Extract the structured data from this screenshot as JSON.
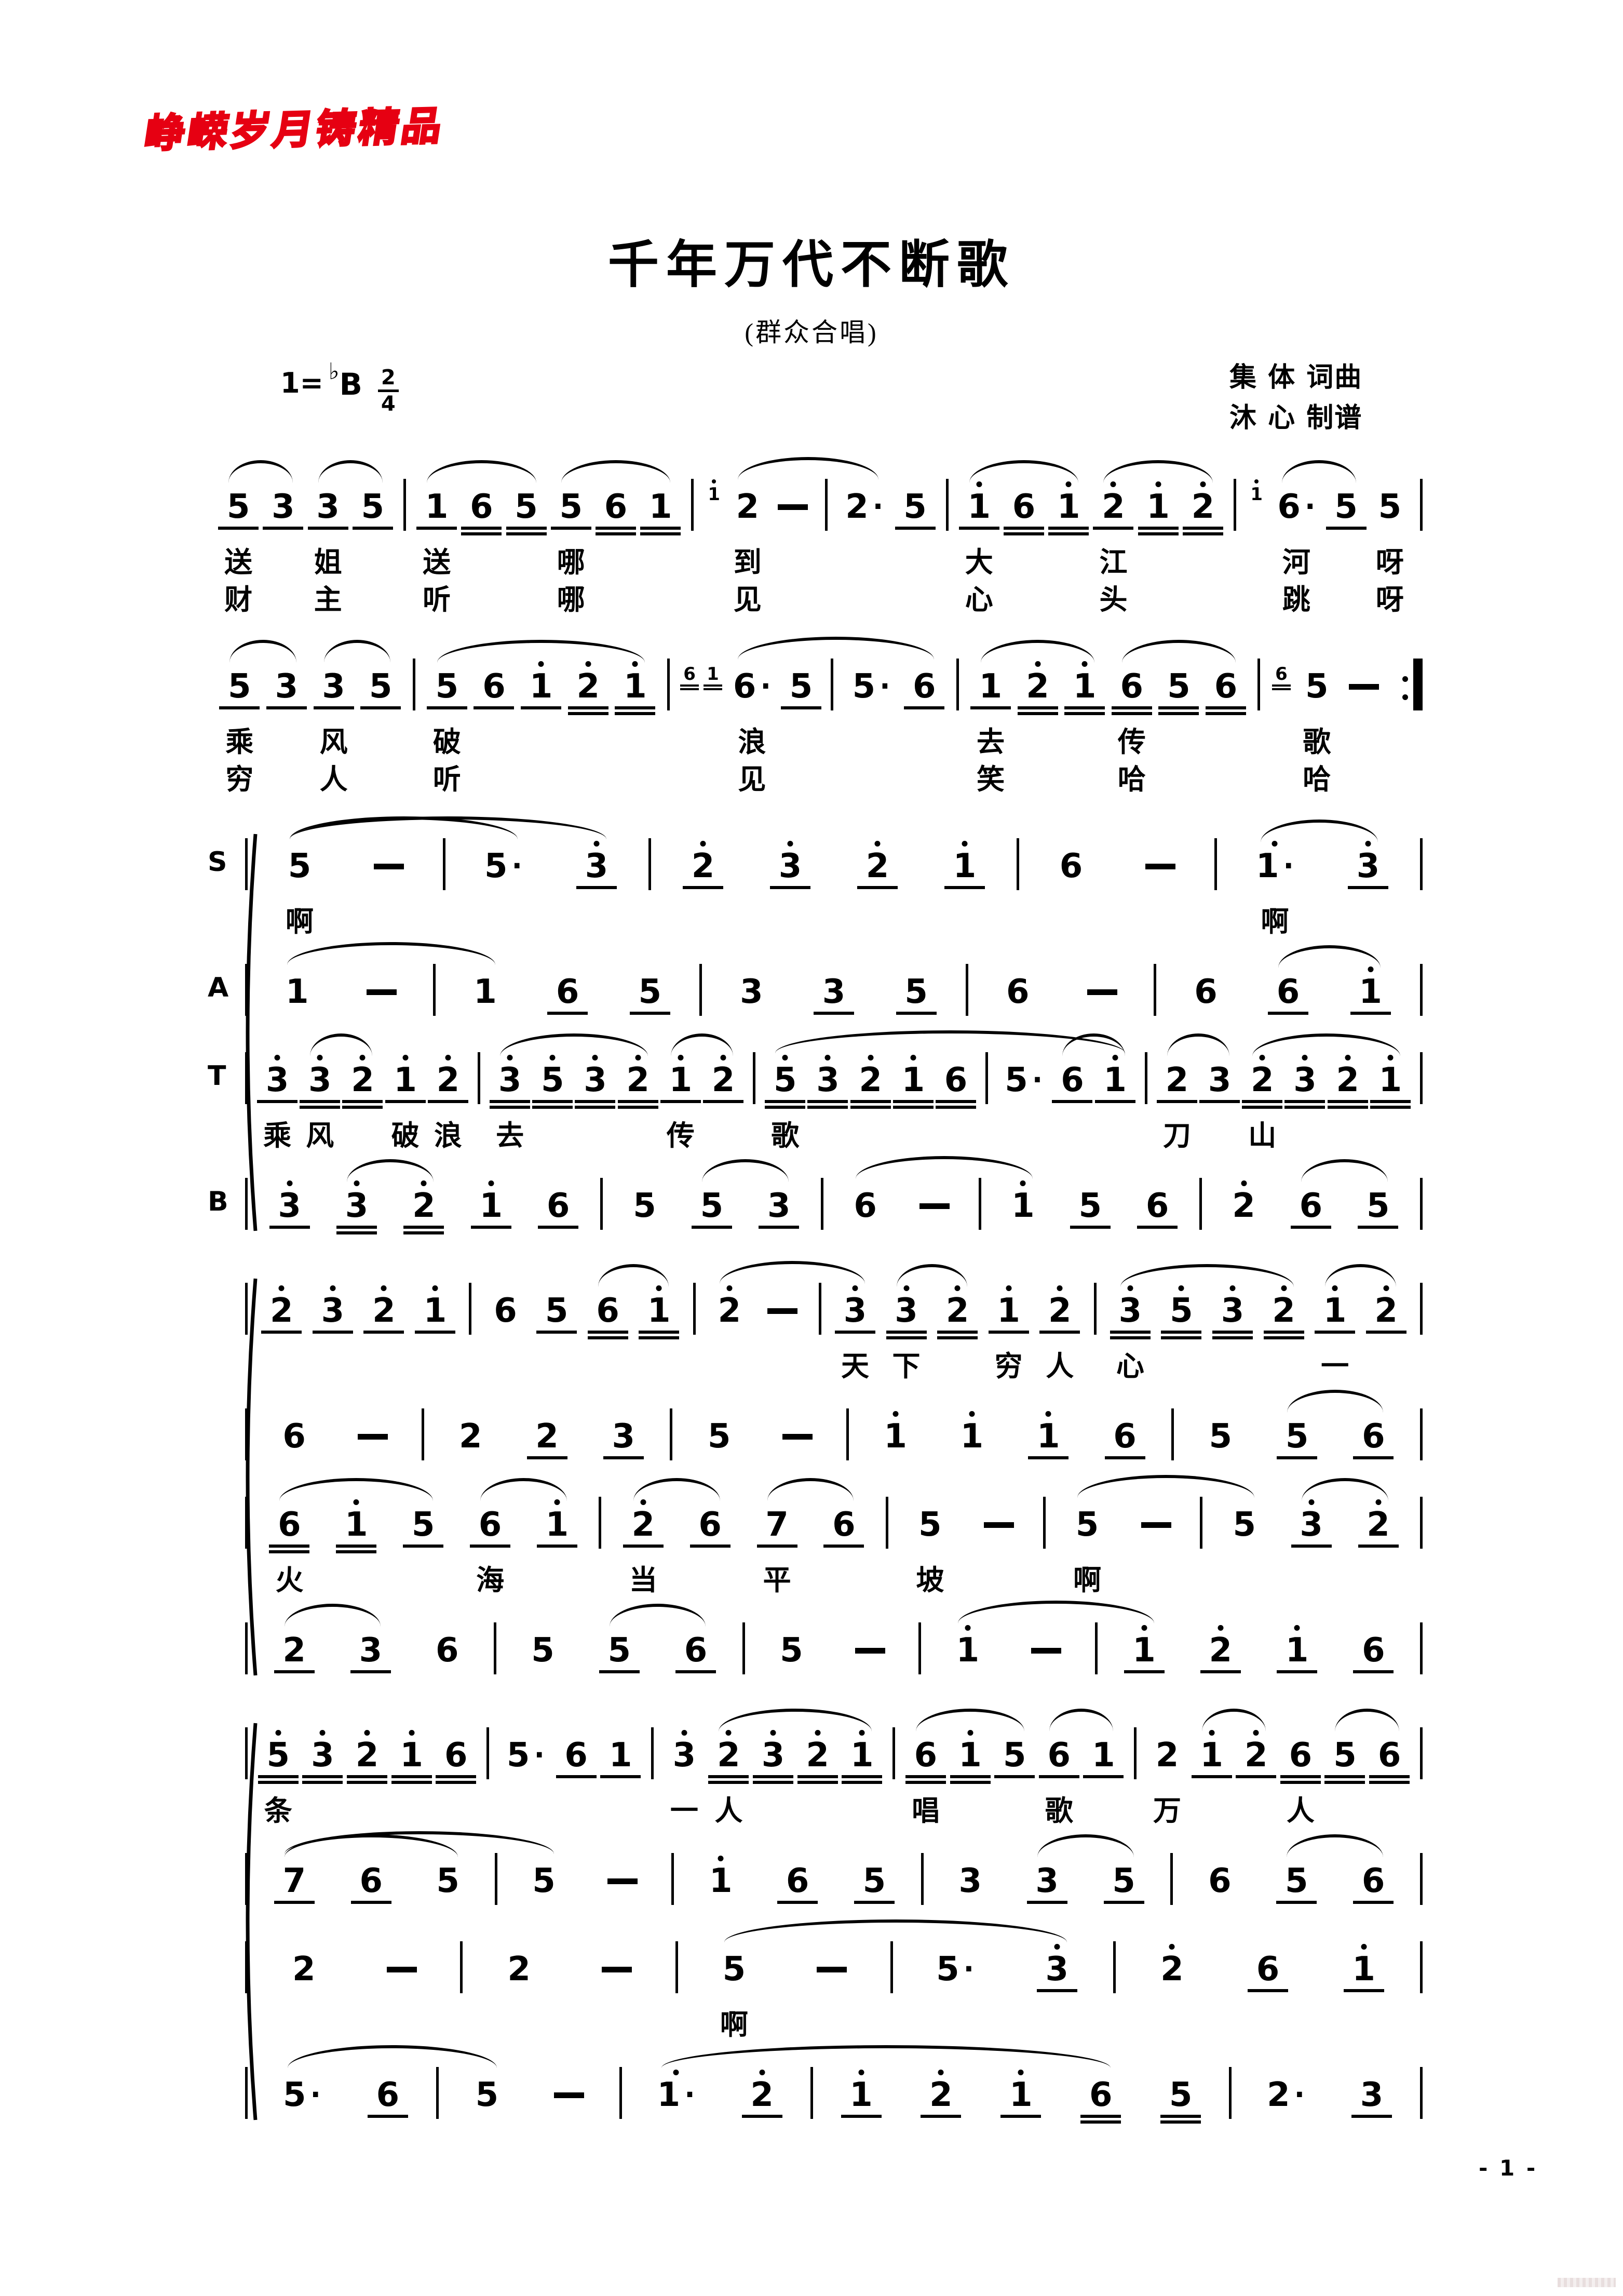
{
  "watermark_text": "峥嵘岁月铸精品",
  "title": "千年万代不断歌",
  "subtitle": "(群众合唱)",
  "key": {
    "prefix": "1=",
    "flat": "♭",
    "letter": "B",
    "meter_top": "2",
    "meter_bottom": "4"
  },
  "credits": {
    "line1": "集 体 词曲",
    "line2": "沐 心 制谱"
  },
  "page_number": "- 1 -",
  "systems": [
    {
      "brace": false,
      "lines": [
        {
          "label": "",
          "end": "|",
          "m": [
            {
              "t": "5u1 3u1 3u1 5u1"
            },
            {
              "t": "1u1 6u2 5u2 5u1 6u2 1u2"
            },
            {
              "g": "1'",
              "t": "2 -"
            },
            {
              "t": "2. 5u1"
            },
            {
              "t": "1'u1 6u2 1'u2 2'u1 1'u2 2'u2"
            },
            {
              "g": "1'",
              "t": "6. 5u1 5"
            }
          ],
          "s": [
            [
              0,
              0,
              0,
              1
            ],
            [
              0,
              2,
              0,
              3
            ],
            [
              1,
              0,
              1,
              2
            ],
            [
              1,
              3,
              1,
              5
            ],
            [
              2,
              0,
              3,
              0
            ],
            [
              4,
              0,
              4,
              2
            ],
            [
              4,
              3,
              4,
              5
            ],
            [
              5,
              0,
              5,
              1
            ]
          ],
          "lyr": [
            {
              "0": {
                "0": "送",
                "2": "姐"
              },
              "1": {
                "0": "送",
                "3": "哪"
              },
              "2": {
                "0": "到"
              },
              "4": {
                "0": "大",
                "3": "江"
              },
              "5": {
                "0": "河",
                "2": "呀"
              }
            },
            {
              "0": {
                "0": "财",
                "2": "主"
              },
              "1": {
                "0": "听",
                "3": "哪"
              },
              "2": {
                "0": "见"
              },
              "4": {
                "0": "心",
                "3": "头"
              },
              "5": {
                "0": "跳",
                "2": "呀"
              }
            }
          ]
        }
      ]
    },
    {
      "brace": false,
      "lines": [
        {
          "label": "",
          "end": ":||",
          "m": [
            {
              "t": "5u1 3u1 3u1 5u1"
            },
            {
              "t": "5u1 6u1 1'u1 2'u2 1'u2"
            },
            {
              "g": "6u2 1u2",
              "t": "6. 5u1"
            },
            {
              "t": "5. 6u1"
            },
            {
              "t": "1u1 2'u2 1'u2 6u2 5u2 6u2"
            },
            {
              "g": "6u2",
              "t": "5 -"
            }
          ],
          "s": [
            [
              0,
              0,
              0,
              1
            ],
            [
              0,
              2,
              0,
              3
            ],
            [
              1,
              0,
              1,
              4
            ],
            [
              2,
              0,
              3,
              1
            ],
            [
              4,
              0,
              4,
              2
            ],
            [
              4,
              3,
              4,
              5
            ]
          ],
          "lyr": [
            {
              "0": {
                "0": "乘",
                "2": "风"
              },
              "1": {
                "0": "破"
              },
              "2": {
                "0": "浪"
              },
              "4": {
                "0": "去",
                "3": "传"
              },
              "5": {
                "0": "歌"
              }
            },
            {
              "0": {
                "0": "穷",
                "2": "人"
              },
              "1": {
                "0": "听"
              },
              "2": {
                "0": "见"
              },
              "4": {
                "0": "笑",
                "3": "哈"
              },
              "5": {
                "0": "哈"
              }
            }
          ]
        }
      ]
    },
    {
      "brace": true,
      "lines": [
        {
          "label": "S",
          "end": "|",
          "m": [
            {
              "t": "5 -"
            },
            {
              "t": "5. 3'u1"
            },
            {
              "t": "2'u1 3'u1 2'u1 1'u1"
            },
            {
              "t": "6 -"
            },
            {
              "t": "1'. 3'u1"
            }
          ],
          "s": [
            [
              0,
              0,
              1,
              0
            ],
            [
              0,
              0,
              1,
              1
            ],
            [
              4,
              0,
              4,
              1
            ]
          ],
          "lyr": [
            {
              "0": {
                "0": "啊"
              },
              "4": {
                "0": "啊"
              }
            }
          ]
        },
        {
          "label": "A",
          "end": "|",
          "m": [
            {
              "t": "1 -"
            },
            {
              "t": "1 6u1 5u1"
            },
            {
              "t": "3 3u1 5u1"
            },
            {
              "t": "6 -"
            },
            {
              "t": "6 6u1 1'u1"
            }
          ],
          "s": [
            [
              0,
              0,
              1,
              0
            ],
            [
              4,
              1,
              4,
              2
            ]
          ],
          "lyr": []
        },
        {
          "label": "T",
          "end": "|",
          "m": [
            {
              "t": "3'u1 3'u2 2'u2 1'u1 2'u1"
            },
            {
              "t": "3'u2 5'u2 3'u2 2'u2 1'u1 2'u1"
            },
            {
              "t": "5'u2 3'u2 2'u2 1'u2 6u2"
            },
            {
              "t": "5. 6u1 1'u1"
            },
            {
              "t": "2u1 3u1 2'u2 3'u2 2'u2 1'u2"
            }
          ],
          "s": [
            [
              0,
              1,
              0,
              2
            ],
            [
              1,
              0,
              1,
              3
            ],
            [
              1,
              4,
              1,
              5
            ],
            [
              2,
              0,
              3,
              2
            ],
            [
              3,
              1,
              3,
              2
            ],
            [
              4,
              0,
              4,
              1
            ],
            [
              4,
              2,
              4,
              5
            ]
          ],
          "lyr": [
            {
              "0": {
                "0": "乘",
                "1": "风",
                "3": "破",
                "4": "浪"
              },
              "1": {
                "0": "去",
                "4": "传"
              },
              "2": {
                "0": "歌"
              },
              "4": {
                "0": "刀",
                "2": "山"
              }
            }
          ]
        },
        {
          "label": "B",
          "end": "|",
          "m": [
            {
              "t": "3'u1 3'u2 2'u2 1'u1 6u1"
            },
            {
              "t": "5 5u1 3u1"
            },
            {
              "t": "6 -"
            },
            {
              "t": "1' 5u1 6u1"
            },
            {
              "t": "2' 6u1 5u1"
            }
          ],
          "s": [
            [
              0,
              1,
              0,
              2
            ],
            [
              1,
              1,
              1,
              2
            ],
            [
              2,
              0,
              3,
              0
            ],
            [
              4,
              1,
              4,
              2
            ]
          ],
          "lyr": []
        }
      ]
    },
    {
      "brace": true,
      "lines": [
        {
          "label": "",
          "end": "|",
          "m": [
            {
              "t": "2'u1 3'u1 2'u1 1'u1"
            },
            {
              "t": "6 5u1 6u2 1'u2"
            },
            {
              "t": "2' -"
            },
            {
              "t": "3'u1 3'u2 2'u2 1'u1 2'u1"
            },
            {
              "t": "3'u2 5'u2 3'u2 2'u2 1'u1 2'u1"
            }
          ],
          "s": [
            [
              1,
              2,
              1,
              3
            ],
            [
              2,
              0,
              3,
              0
            ],
            [
              3,
              1,
              3,
              2
            ],
            [
              4,
              0,
              4,
              3
            ],
            [
              4,
              4,
              4,
              5
            ]
          ],
          "lyr": [
            {
              "3": {
                "0": "天",
                "1": "下",
                "3": "穷",
                "4": "人"
              },
              "4": {
                "0": "心",
                "4": "一"
              }
            }
          ]
        },
        {
          "label": "",
          "end": "|",
          "m": [
            {
              "t": "6 -"
            },
            {
              "t": "2 2u1 3u1"
            },
            {
              "t": "5 -"
            },
            {
              "t": "1' 1' 1'u1 6u1"
            },
            {
              "t": "5 5u1 6u1"
            }
          ],
          "s": [
            [
              4,
              1,
              4,
              2
            ]
          ],
          "lyr": []
        },
        {
          "label": "",
          "end": "|",
          "m": [
            {
              "t": "6u2 1'u2 5u1 6u1 1'u1"
            },
            {
              "t": "2'u1 6u1 7u1 6u1"
            },
            {
              "t": "5 -"
            },
            {
              "t": "5 -"
            },
            {
              "t": "5 3'u1 2'u1"
            }
          ],
          "s": [
            [
              0,
              0,
              0,
              2
            ],
            [
              0,
              3,
              0,
              4
            ],
            [
              1,
              0,
              1,
              1
            ],
            [
              1,
              2,
              1,
              3
            ],
            [
              3,
              0,
              4,
              0
            ],
            [
              4,
              1,
              4,
              2
            ]
          ],
          "lyr": [
            {
              "0": {
                "0": "火",
                "3": "海"
              },
              "1": {
                "0": "当",
                "2": "平"
              },
              "2": {
                "0": "坡"
              },
              "3": {
                "0": "啊"
              }
            }
          ]
        },
        {
          "label": "",
          "end": "|",
          "m": [
            {
              "t": "2u1 3u1 6"
            },
            {
              "t": "5 5u1 6u1"
            },
            {
              "t": "5 -"
            },
            {
              "t": "1' -"
            },
            {
              "t": "1'u1 2'u1 1'u1 6u1"
            }
          ],
          "s": [
            [
              0,
              0,
              0,
              1
            ],
            [
              1,
              1,
              1,
              2
            ],
            [
              3,
              0,
              4,
              0
            ]
          ],
          "lyr": []
        }
      ]
    },
    {
      "brace": true,
      "lines": [
        {
          "label": "",
          "end": "|",
          "m": [
            {
              "t": "5'u2 3'u2 2'u2 1'u2 6u2"
            },
            {
              "t": "5. 6u1 1u1"
            },
            {
              "t": "3' 2'u2 3'u2 2'u2 1'u2"
            },
            {
              "t": "6u2 1'u2 5u1 6u1 1u1"
            },
            {
              "t": "2 1'u1 2'u1 6u2 5u2 6u2"
            }
          ],
          "s": [
            [
              2,
              1,
              2,
              4
            ],
            [
              3,
              0,
              3,
              2
            ],
            [
              3,
              3,
              3,
              4
            ],
            [
              4,
              1,
              4,
              2
            ],
            [
              4,
              4,
              4,
              5
            ]
          ],
          "lyr": [
            {
              "0": {
                "0": "条"
              },
              "2": {
                "0": "一",
                "1": "人"
              },
              "3": {
                "0": "唱",
                "3": "歌"
              },
              "4": {
                "0": "万",
                "3": "人"
              }
            }
          ]
        },
        {
          "label": "",
          "end": "|",
          "m": [
            {
              "t": "7u1 6u1 5"
            },
            {
              "t": "5 -"
            },
            {
              "t": "1' 6u1 5u1"
            },
            {
              "t": "3 3u1 5u1"
            },
            {
              "t": "6 5u1 6u1"
            }
          ],
          "s": [
            [
              0,
              0,
              0,
              2
            ],
            [
              0,
              0,
              1,
              0
            ],
            [
              3,
              1,
              3,
              2
            ],
            [
              4,
              1,
              4,
              2
            ]
          ],
          "lyr": []
        },
        {
          "label": "",
          "end": "|",
          "m": [
            {
              "t": "2 -"
            },
            {
              "t": "2 -"
            },
            {
              "t": "5 -"
            },
            {
              "t": "5. 3'u1"
            },
            {
              "t": "2' 6u1 1'u1"
            }
          ],
          "s": [
            [
              2,
              0,
              3,
              1
            ]
          ],
          "lyr": [
            {
              "2": {
                "0": "啊"
              }
            }
          ]
        },
        {
          "label": "",
          "end": "|",
          "m": [
            {
              "t": "5. 6u1"
            },
            {
              "t": "5 -"
            },
            {
              "t": "1'. 2'u1"
            },
            {
              "t": "1'u1 2'u1 1'u1 6u2 5u2"
            },
            {
              "t": "2. 3u1"
            }
          ],
          "s": [
            [
              0,
              0,
              1,
              0
            ],
            [
              2,
              0,
              3,
              3
            ]
          ],
          "lyr": []
        }
      ]
    }
  ]
}
